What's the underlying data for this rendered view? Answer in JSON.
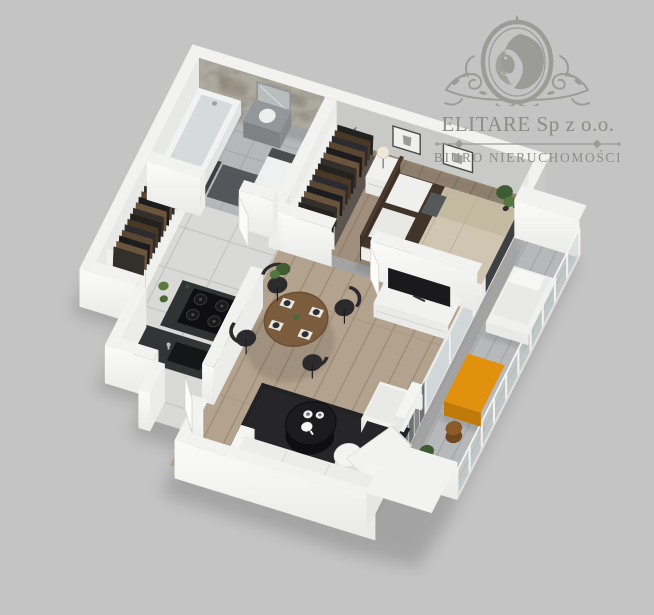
{
  "logo": {
    "company": "ELITARE Sp z o.o.",
    "subtitle": "BIURO NIERUCHOMOŚCI",
    "emblem": "lion-crest-icon"
  },
  "palette": {
    "bg": "#c4c4c4",
    "logoColor": "#9b9b98",
    "logoText": "#8c8c89",
    "wallTop": "#f2f2f0",
    "stone": "#8a8077",
    "woodLiving": "#b3a28d",
    "woodBed": "#a08f7c",
    "tile": "#d9d9d7",
    "bathTile": "#b5b7b8",
    "rug": "#232325",
    "counter": "#303234",
    "accent": "#e2910e",
    "sofa": "#f2f2f0",
    "chairDark": "#2b2b2d",
    "tableWood": "#7b5c3d",
    "green": "#4d6a39",
    "glass": "#ccd4d6",
    "bedding": "#cfc5b0",
    "bedThrow": "#41352a",
    "balconyFloor": "#b6b8b9"
  },
  "scene": {
    "type": "3d-floor-plan-render",
    "rooms": [
      "bathroom",
      "hallway",
      "kitchen",
      "bedroom",
      "living-room",
      "balcony"
    ],
    "objects": [
      "stone-accent-wall",
      "bathtub",
      "vanity-sink",
      "mirror",
      "washing-machine",
      "hall-wardrobe",
      "bedroom-wardrobe",
      "double-bed",
      "nightstand",
      "table-lamp",
      "wall-art-frames",
      "kitchen-stove",
      "oven",
      "kitchen-sink",
      "dining-table",
      "dining-chairs",
      "potted-plants",
      "tv-console",
      "tv",
      "area-rug",
      "coffee-table",
      "tea-set",
      "sofa",
      "armchair",
      "pouf",
      "chaise-lounge",
      "glass-railing",
      "balcony-lounger",
      "balcony-table",
      "entrance-door"
    ]
  }
}
